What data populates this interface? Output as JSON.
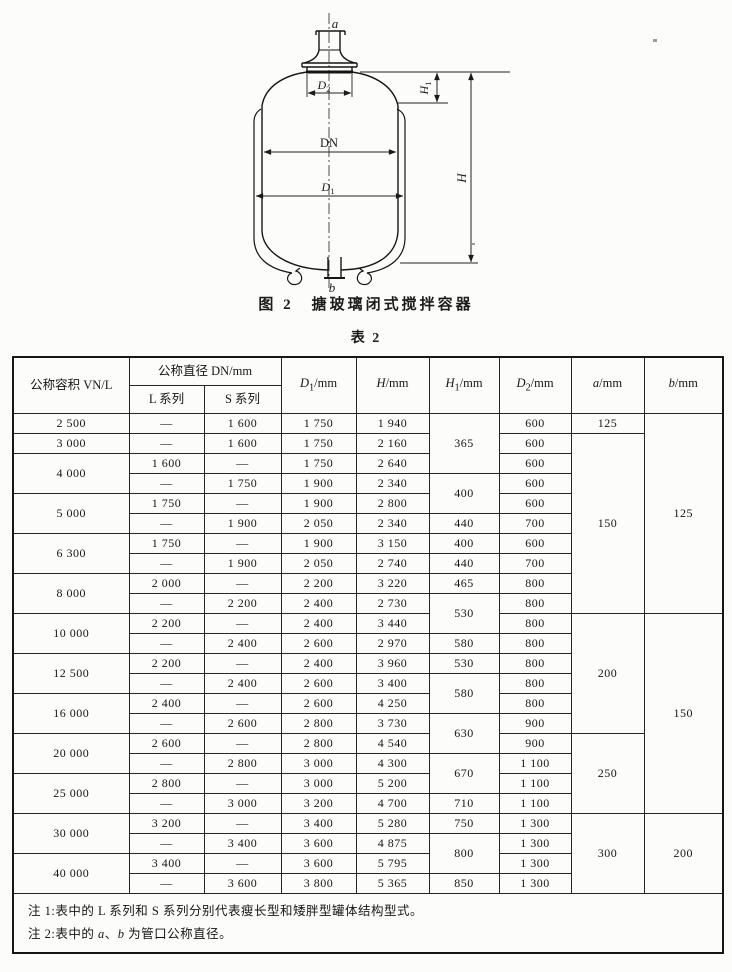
{
  "figure": {
    "caption": "图 2　搪玻璃闭式搅拌容器",
    "labels": {
      "a": "a",
      "b": "b",
      "d2_sym": "D",
      "d2_sub": "2",
      "dn": "DN",
      "d1_sym": "D",
      "d1_sub": "1",
      "h1_sym": "H",
      "h1_sub": "1",
      "h_sym": "H"
    }
  },
  "table": {
    "title": "表 2",
    "header": {
      "vn": "公称容积 VN/L",
      "dn_group": "公称直径 DN/mm",
      "l_series": "L 系列",
      "s_series": "S 系列",
      "d1": {
        "sym": "D",
        "sub": "1",
        "unit": "/mm"
      },
      "h": {
        "sym": "H",
        "sub": "",
        "unit": "/mm"
      },
      "h1": {
        "sym": "H",
        "sub": "1",
        "unit": "/mm"
      },
      "d2": {
        "sym": "D",
        "sub": "2",
        "unit": "/mm"
      },
      "a": {
        "sym": "a",
        "sub": "",
        "unit": "/mm"
      },
      "b": {
        "sym": "b",
        "sub": "",
        "unit": "/mm"
      }
    },
    "rows": [
      [
        {
          "t": "2 500"
        },
        {
          "t": "—"
        },
        {
          "t": "1 600"
        },
        {
          "t": "1 750"
        },
        {
          "t": "1 940"
        },
        {
          "t": "365",
          "rs": 3
        },
        {
          "t": "600"
        },
        {
          "t": "125"
        },
        {
          "t": "125",
          "rs": 10
        }
      ],
      [
        {
          "t": "3 000"
        },
        {
          "t": "—"
        },
        {
          "t": "1 600"
        },
        {
          "t": "1 750"
        },
        {
          "t": "2 160"
        },
        {
          "t": "600"
        },
        {
          "t": "150",
          "rs": 9
        }
      ],
      [
        {
          "t": "4 000",
          "rs": 2
        },
        {
          "t": "1 600"
        },
        {
          "t": "—"
        },
        {
          "t": "1 750"
        },
        {
          "t": "2 640"
        },
        {
          "t": "600"
        }
      ],
      [
        {
          "t": "—"
        },
        {
          "t": "1 750"
        },
        {
          "t": "1 900"
        },
        {
          "t": "2 340"
        },
        {
          "t": "400",
          "rs": 2
        },
        {
          "t": "600"
        }
      ],
      [
        {
          "t": "5 000",
          "rs": 2
        },
        {
          "t": "1 750"
        },
        {
          "t": "—"
        },
        {
          "t": "1 900"
        },
        {
          "t": "2 800"
        },
        {
          "t": "600"
        }
      ],
      [
        {
          "t": "—"
        },
        {
          "t": "1 900"
        },
        {
          "t": "2 050"
        },
        {
          "t": "2 340"
        },
        {
          "t": "440"
        },
        {
          "t": "700"
        }
      ],
      [
        {
          "t": "6 300",
          "rs": 2
        },
        {
          "t": "1 750"
        },
        {
          "t": "—"
        },
        {
          "t": "1 900"
        },
        {
          "t": "3 150"
        },
        {
          "t": "400"
        },
        {
          "t": "600"
        }
      ],
      [
        {
          "t": "—"
        },
        {
          "t": "1 900"
        },
        {
          "t": "2 050"
        },
        {
          "t": "2 740"
        },
        {
          "t": "440"
        },
        {
          "t": "700"
        }
      ],
      [
        {
          "t": "8 000",
          "rs": 2
        },
        {
          "t": "2 000"
        },
        {
          "t": "—"
        },
        {
          "t": "2 200"
        },
        {
          "t": "3 220"
        },
        {
          "t": "465"
        },
        {
          "t": "800"
        }
      ],
      [
        {
          "t": "—"
        },
        {
          "t": "2 200"
        },
        {
          "t": "2 400"
        },
        {
          "t": "2 730"
        },
        {
          "t": "530",
          "rs": 2
        },
        {
          "t": "800"
        }
      ],
      [
        {
          "t": "10 000",
          "rs": 2
        },
        {
          "t": "2 200"
        },
        {
          "t": "—"
        },
        {
          "t": "2 400"
        },
        {
          "t": "3 440"
        },
        {
          "t": "800"
        },
        {
          "t": "200",
          "rs": 6
        },
        {
          "t": "150",
          "rs": 10
        }
      ],
      [
        {
          "t": "—"
        },
        {
          "t": "2 400"
        },
        {
          "t": "2 600"
        },
        {
          "t": "2 970"
        },
        {
          "t": "580"
        },
        {
          "t": "800"
        }
      ],
      [
        {
          "t": "12 500",
          "rs": 2
        },
        {
          "t": "2 200"
        },
        {
          "t": "—"
        },
        {
          "t": "2 400"
        },
        {
          "t": "3 960"
        },
        {
          "t": "530"
        },
        {
          "t": "800"
        }
      ],
      [
        {
          "t": "—"
        },
        {
          "t": "2 400"
        },
        {
          "t": "2 600"
        },
        {
          "t": "3 400"
        },
        {
          "t": "580",
          "rs": 2
        },
        {
          "t": "800"
        }
      ],
      [
        {
          "t": "16 000",
          "rs": 2
        },
        {
          "t": "2 400"
        },
        {
          "t": "—"
        },
        {
          "t": "2 600"
        },
        {
          "t": "4 250"
        },
        {
          "t": "800"
        }
      ],
      [
        {
          "t": "—"
        },
        {
          "t": "2 600"
        },
        {
          "t": "2 800"
        },
        {
          "t": "3 730"
        },
        {
          "t": "630",
          "rs": 2
        },
        {
          "t": "900"
        }
      ],
      [
        {
          "t": "20 000",
          "rs": 2
        },
        {
          "t": "2 600"
        },
        {
          "t": "—"
        },
        {
          "t": "2 800"
        },
        {
          "t": "4 540"
        },
        {
          "t": "900"
        },
        {
          "t": "250",
          "rs": 4
        }
      ],
      [
        {
          "t": "—"
        },
        {
          "t": "2 800"
        },
        {
          "t": "3 000"
        },
        {
          "t": "4 300"
        },
        {
          "t": "670",
          "rs": 2
        },
        {
          "t": "1 100"
        }
      ],
      [
        {
          "t": "25 000",
          "rs": 2
        },
        {
          "t": "2 800"
        },
        {
          "t": "—"
        },
        {
          "t": "3 000"
        },
        {
          "t": "5 200"
        },
        {
          "t": "1 100"
        }
      ],
      [
        {
          "t": "—"
        },
        {
          "t": "3 000"
        },
        {
          "t": "3 200"
        },
        {
          "t": "4 700"
        },
        {
          "t": "710"
        },
        {
          "t": "1 100"
        }
      ],
      [
        {
          "t": "30 000",
          "rs": 2
        },
        {
          "t": "3 200"
        },
        {
          "t": "—"
        },
        {
          "t": "3 400"
        },
        {
          "t": "5 280"
        },
        {
          "t": "750"
        },
        {
          "t": "1 300"
        },
        {
          "t": "300",
          "rs": 4
        },
        {
          "t": "200",
          "rs": 4
        }
      ],
      [
        {
          "t": "—"
        },
        {
          "t": "3 400"
        },
        {
          "t": "3 600"
        },
        {
          "t": "4 875"
        },
        {
          "t": "800",
          "rs": 2
        },
        {
          "t": "1 300"
        }
      ],
      [
        {
          "t": "40 000",
          "rs": 2
        },
        {
          "t": "3 400"
        },
        {
          "t": "—"
        },
        {
          "t": "3 600"
        },
        {
          "t": "5 795"
        },
        {
          "t": "1 300"
        }
      ],
      [
        {
          "t": "—"
        },
        {
          "t": "3 600"
        },
        {
          "t": "3 800"
        },
        {
          "t": "5 365"
        },
        {
          "t": "850"
        },
        {
          "t": "1 300"
        }
      ]
    ],
    "notes": {
      "note1": "注 1:表中的 L 系列和 S 系列分别代表瘦长型和矮胖型罐体结构型式。",
      "note2_p1": "注 2:表中的 ",
      "note2_a": "a",
      "note2_sep": "、",
      "note2_b": "b",
      "note2_p2": " 为管口公称直径。"
    }
  },
  "colors": {
    "ink": "#1c1c1c",
    "paper": "#fcfcfa"
  }
}
